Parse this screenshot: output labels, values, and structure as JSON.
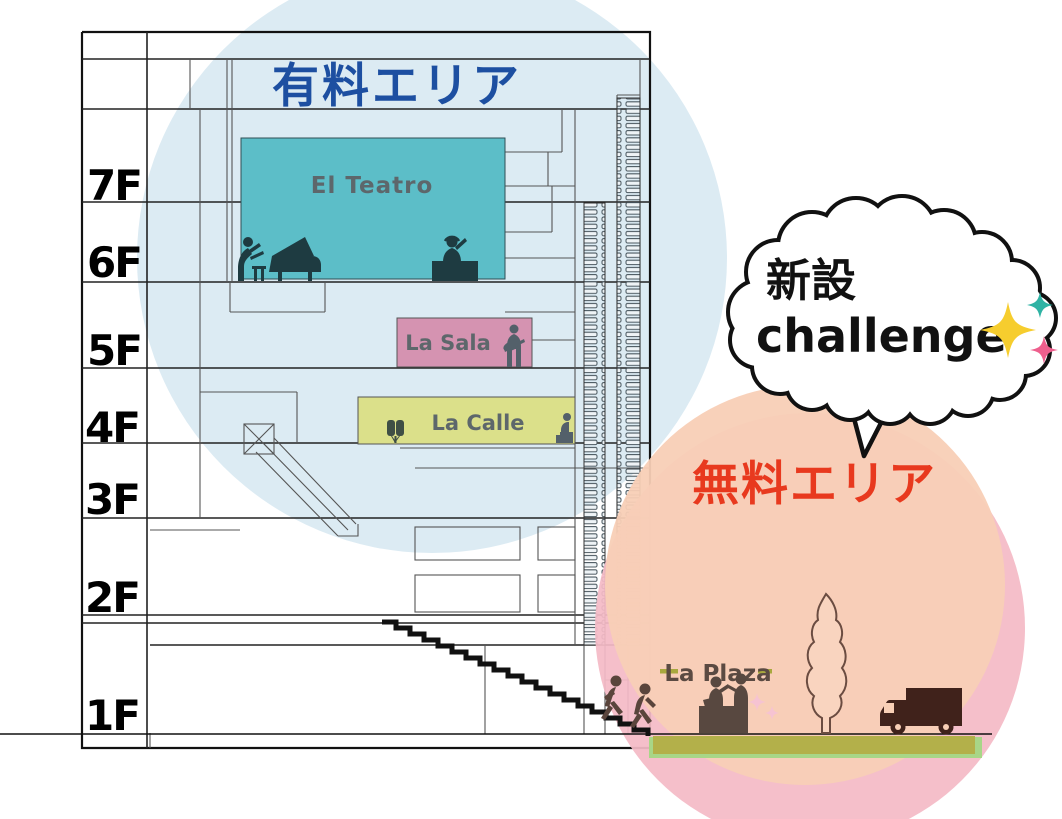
{
  "diagram": {
    "type": "building-cross-section",
    "paid_area": {
      "label": "有料エリア",
      "text_color": "#1d4fa1",
      "circle_color": "#dcebf3"
    },
    "free_area": {
      "label": "無料エリア",
      "text_color": "#e8391e",
      "circle_colors": [
        "#f4bac6",
        "#f8cfb6"
      ]
    },
    "bubble": {
      "line1": "新設",
      "line2": "challenge",
      "sparkle_colors": [
        "#f6cd2e",
        "#2fb3a4",
        "#ee5f8d"
      ]
    },
    "floors": [
      {
        "label": "7F"
      },
      {
        "label": "6F"
      },
      {
        "label": "5F"
      },
      {
        "label": "4F"
      },
      {
        "label": "3F"
      },
      {
        "label": "2F"
      },
      {
        "label": "1F"
      }
    ],
    "venues": [
      {
        "name": "El Teatro",
        "color": "#5cbec8",
        "icons": [
          "pianist-piano-icon",
          "dj-icon"
        ]
      },
      {
        "name": "La Sala",
        "color": "#d593b1",
        "icons": [
          "guitarist-icon"
        ]
      },
      {
        "name": "La Calle",
        "color": "#dbe08a",
        "icons": [
          "bongos-icon",
          "seated-performer-icon"
        ]
      },
      {
        "name": "La Plaza",
        "color": "#b3b04a",
        "icons": [
          "reception-counter-icon",
          "tree-icon",
          "truck-icon",
          "stair-climbing-people-icon"
        ]
      }
    ],
    "ground": {
      "strip_colors": [
        "#b3b04a",
        "#a8d687"
      ]
    }
  }
}
